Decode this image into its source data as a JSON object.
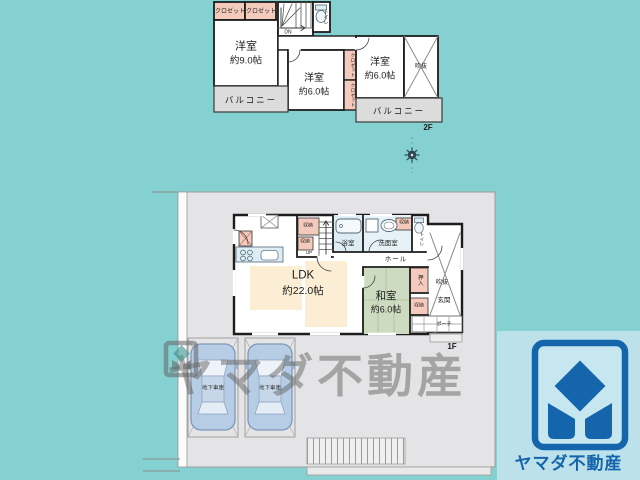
{
  "watermark": {
    "text": "ヤマダ不動産"
  },
  "brand": {
    "name": "ヤマダ不動産"
  },
  "floor2": {
    "floor_label": "2F",
    "closet_top_1": "クロゼット",
    "closet_top_2": "クロゼット",
    "stairs_label": "DN",
    "toilet_label": "トイレ",
    "room_west9": {
      "name": "洋室",
      "size": "約9.0帖"
    },
    "room_center6": {
      "name": "洋室",
      "size": "約6.0帖"
    },
    "room_east6": {
      "name": "洋室",
      "size": "約6.0帖"
    },
    "closet_mid_1": "クロゼット",
    "closet_mid_2": "クロゼット",
    "void_label": "吹抜",
    "balcony_west": "バルコニー",
    "balcony_east": "バルコニー"
  },
  "floor1": {
    "floor_label": "1F",
    "ldk": {
      "name": "LDK",
      "size": "約22.0帖"
    },
    "japanese_room": {
      "name": "和室",
      "size": "約6.0帖"
    },
    "bath_label": "浴室",
    "washroom_label": "洗面室",
    "toilet_label": "トイレ",
    "hall_label": "ホール",
    "stairs_label": "UP",
    "storage_stairs_1": "収納",
    "storage_stairs_2": "収納",
    "storage_washroom": "収納",
    "storage_japanese": "収納",
    "oshiire_label": "押入",
    "void_label": "吹抜",
    "entrance_label": "玄関",
    "porch_label": "ポーチ",
    "garage_1": "地下車庫",
    "garage_2": "地下車庫"
  },
  "colors": {
    "background": "#85d1d2",
    "site_gray": "#e4e4e6",
    "wall": "#1d1d1d",
    "tatami_green": "#cddcc0",
    "storage_pink": "#f4cabc",
    "water_blue": "#dcedf4",
    "rug_cream": "#fbeed4",
    "balcony_gray": "#dcdcdd",
    "car_blue": "#b7cde6",
    "logo_blue": "#1565ad",
    "logo_patch_bg": "#bce1ea",
    "watermark_gray": "#646464"
  }
}
